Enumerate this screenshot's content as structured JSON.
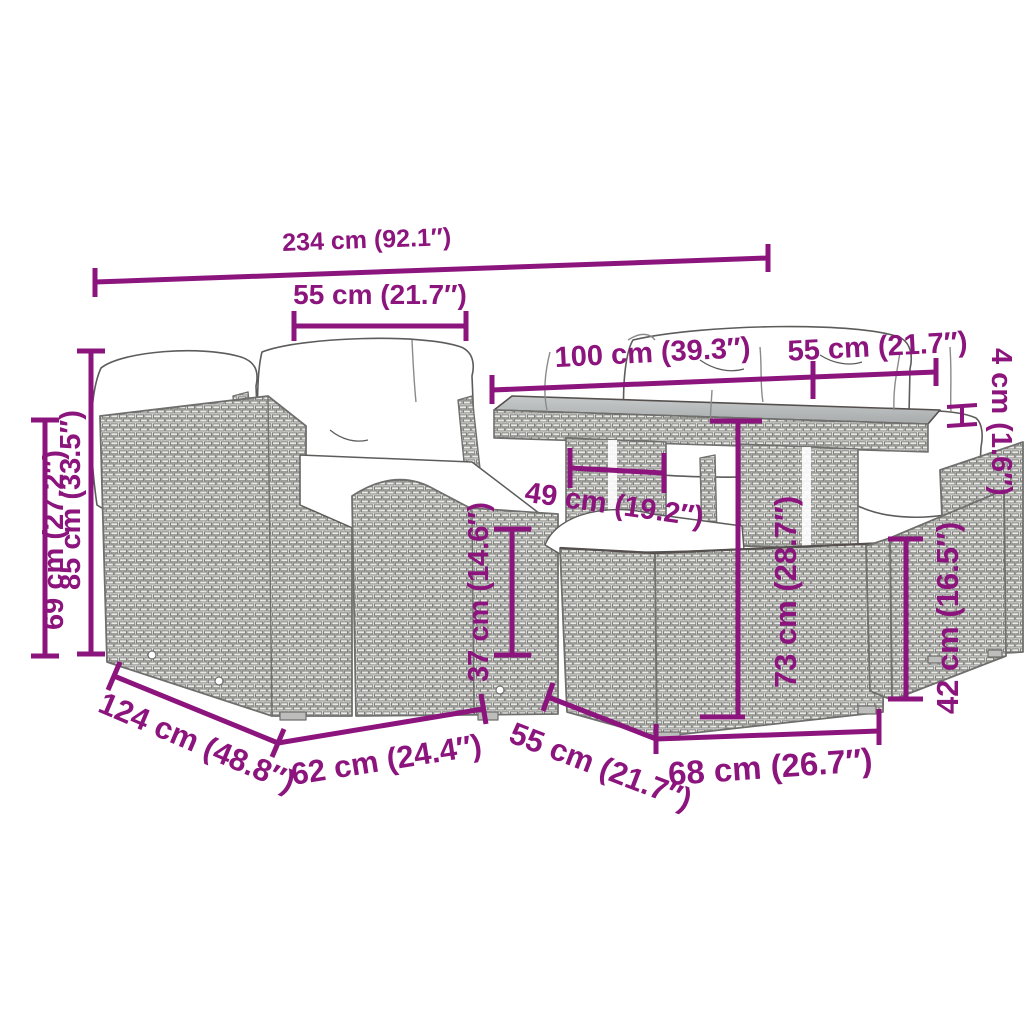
{
  "meta": {
    "description": "Dimension diagram of a poly rattan garden lounge set: corner sofa sections with cushions, glass-top table, footstool and ottomans",
    "accent_color": "#8C147D",
    "line_art_color": "#6f6f6d",
    "units": "cm (inches)"
  },
  "dimensions": {
    "total_width": "234 cm (92.1″)",
    "seat_section_width": "55 cm (21.7″)",
    "table_length": "100 cm (39.3″)",
    "table_depth": "55 cm (21.7″)",
    "table_top_thickness": "4 cm (1.6″)",
    "armrest_height": "69 cm (27.2″)",
    "backrest_height": "85 cm (33.5″)",
    "table_frame_width": "49 cm (19.2″)",
    "footstool_height": "37 cm (14.6″)",
    "table_height": "73 cm (28.7″)",
    "ottoman_height": "42 cm (16.5″)",
    "set_depth": "124 cm (48.8″)",
    "seat_depth": "62 cm (24.4″)",
    "footstool_depth": "55 cm (21.7″)",
    "ottoman_width": "68 cm (26.7″)"
  }
}
